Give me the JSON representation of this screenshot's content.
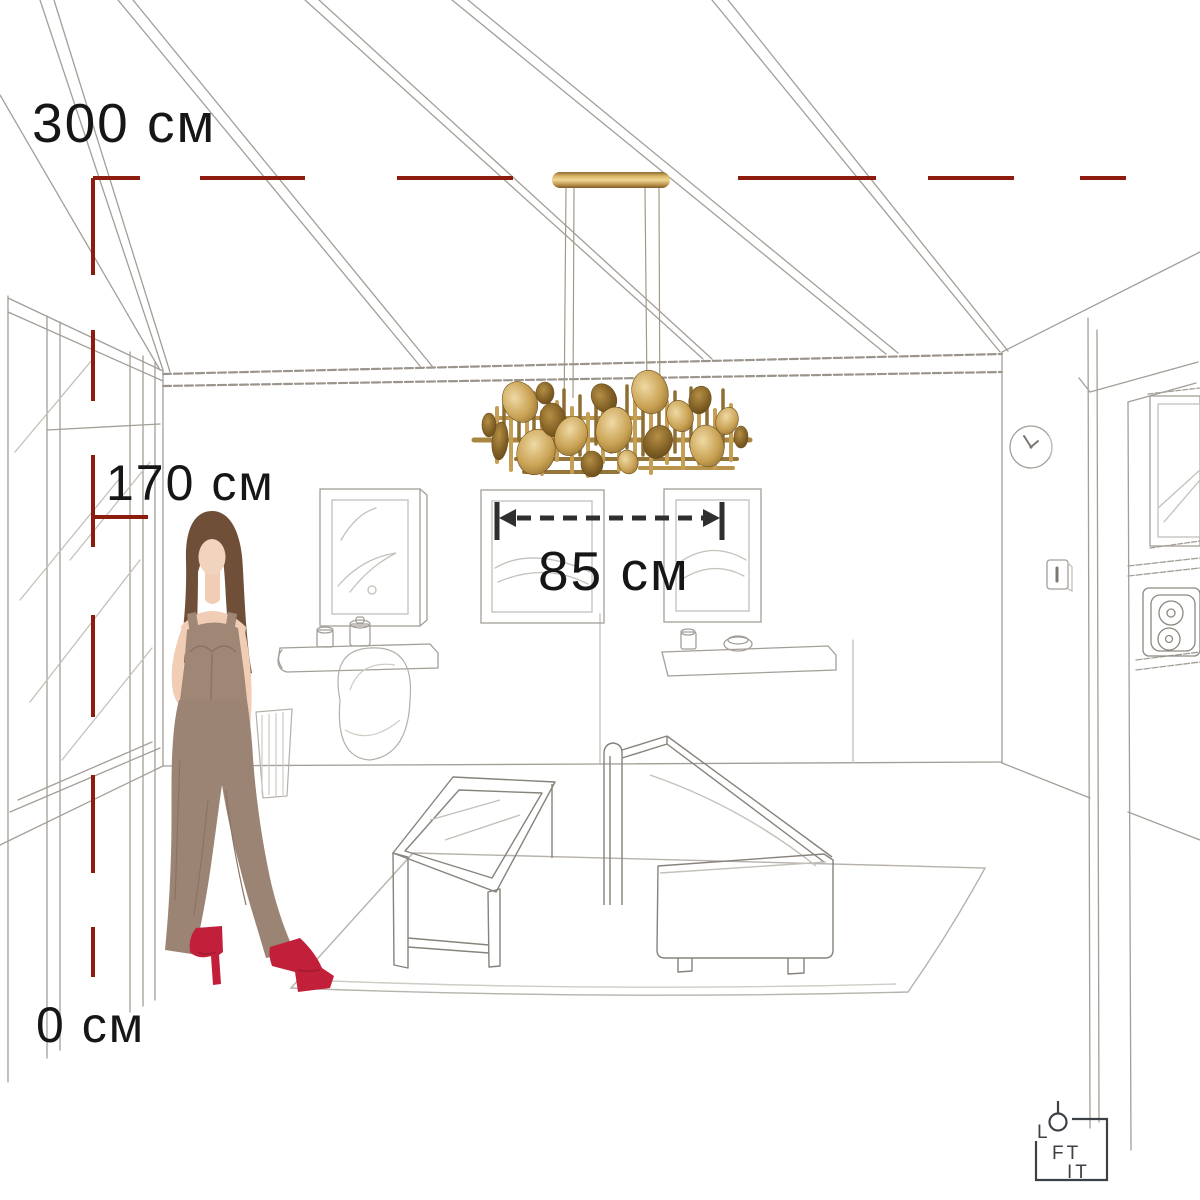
{
  "scene": {
    "type": "product-dimension-illustration",
    "subject": "gold chandelier hanging in a sketched living-room interior with woman figure for scale"
  },
  "dimensions": {
    "ceiling_height": {
      "label": "300 см",
      "value": 300,
      "unit": "см"
    },
    "fixture_clearance": {
      "label": "170 см",
      "value": 170,
      "unit": "см"
    },
    "floor_level": {
      "label": "0 см",
      "value": 0,
      "unit": "см"
    },
    "fixture_width": {
      "label": "85 см",
      "value": 85,
      "unit": "см"
    }
  },
  "brand": {
    "name": "LOFT IT",
    "logo": {
      "line1": "L",
      "line2": "FT",
      "line3": "IT"
    }
  },
  "colors": {
    "background": "#ffffff",
    "dimension_line_red": "#8e1c0e",
    "dimension_line_black": "#2f2f2f",
    "label_text": "#161616",
    "chandelier_gold": "#c9a254",
    "sketch_gray": "#a39e97",
    "figure_outfit": "#9c8475",
    "figure_boots": "#c2203a",
    "logo_ink": "#3c4148"
  }
}
